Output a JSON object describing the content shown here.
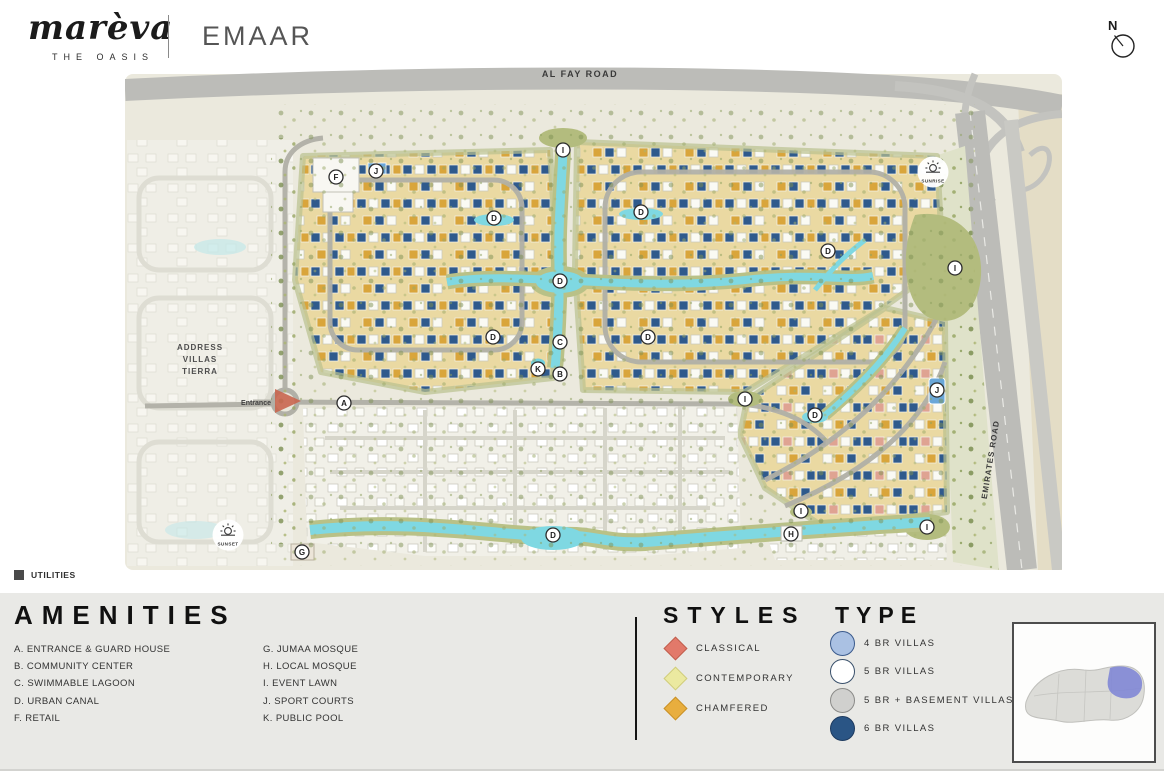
{
  "header": {
    "brand": "marèva",
    "brand_sub": "THE OASIS",
    "partner": "EMAAR",
    "compass_label": "N"
  },
  "map": {
    "road_top_label": "AL FAY ROAD",
    "road_right_label": "EMIRATES ROAD",
    "neighbor_label": [
      "ADDRESS",
      "VILLAS",
      "TIERRA"
    ],
    "entrance_label": "Entrance",
    "sun_badges": [
      {
        "label": "SUNRISE",
        "x": 808,
        "y": 112
      },
      {
        "label": "SUNSET",
        "x": 103,
        "y": 475
      }
    ],
    "markers": [
      {
        "letter": "A",
        "x": 219,
        "y": 343
      },
      {
        "letter": "B",
        "x": 435,
        "y": 314
      },
      {
        "letter": "C",
        "x": 435,
        "y": 282
      },
      {
        "letter": "K",
        "x": 413,
        "y": 309
      },
      {
        "letter": "F",
        "x": 211,
        "y": 117
      },
      {
        "letter": "J",
        "x": 251,
        "y": 111
      },
      {
        "letter": "J",
        "x": 812,
        "y": 330
      },
      {
        "letter": "G",
        "x": 177,
        "y": 492
      },
      {
        "letter": "H",
        "x": 666,
        "y": 474
      },
      {
        "letter": "I",
        "x": 438,
        "y": 90
      },
      {
        "letter": "I",
        "x": 830,
        "y": 208
      },
      {
        "letter": "I",
        "x": 620,
        "y": 339
      },
      {
        "letter": "I",
        "x": 676,
        "y": 451
      },
      {
        "letter": "I",
        "x": 802,
        "y": 467
      },
      {
        "letter": "D",
        "x": 369,
        "y": 158
      },
      {
        "letter": "D",
        "x": 516,
        "y": 152
      },
      {
        "letter": "D",
        "x": 435,
        "y": 221
      },
      {
        "letter": "D",
        "x": 368,
        "y": 277
      },
      {
        "letter": "D",
        "x": 523,
        "y": 277
      },
      {
        "letter": "D",
        "x": 703,
        "y": 191
      },
      {
        "letter": "D",
        "x": 690,
        "y": 355
      },
      {
        "letter": "D",
        "x": 428,
        "y": 475
      }
    ],
    "palette": {
      "sand": "#ebe9dd",
      "road": "#bcbcb8",
      "canal": "#7fd8e2",
      "park": "#b3bc7e",
      "district_yellow": "#ead9a2",
      "future_white": "#f1f0e8"
    }
  },
  "utilities": {
    "label": "UTILITIES",
    "swatch_color": "#4a4a4a"
  },
  "legend": {
    "amenities": {
      "title": "AMENITIES",
      "col1": [
        "A. ENTRANCE & GUARD HOUSE",
        "B. COMMUNITY CENTER",
        "C. SWIMMABLE LAGOON",
        "D. URBAN CANAL",
        "F. RETAIL"
      ],
      "col2": [
        "G. JUMAA MOSQUE",
        "H. LOCAL MOSQUE",
        "I. EVENT LAWN",
        "J. SPORT COURTS",
        "K. PUBLIC POOL"
      ]
    },
    "styles": {
      "title": "STYLES",
      "items": [
        {
          "label": "CLASSICAL",
          "color": "#e2796a",
          "border": "#c05f4e"
        },
        {
          "label": "CONTEMPORARY",
          "color": "#ebe9a0",
          "border": "#cfcc7d"
        },
        {
          "label": "CHAMFERED",
          "color": "#e8ae3e",
          "border": "#c89128"
        }
      ]
    },
    "types": {
      "title": "TYPE",
      "items": [
        {
          "label": "4 BR VILLAS",
          "color": "#aac1e3",
          "border": "#3a5a8c"
        },
        {
          "label": "5 BR VILLAS",
          "color": "#ffffff",
          "border": "#39506b"
        },
        {
          "label": "5 BR + BASEMENT VILLAS",
          "color": "#d0d0ce",
          "border": "#8a8a88"
        },
        {
          "label": "6 BR VILLAS",
          "color": "#2a5585",
          "border": "#1d3a5f"
        }
      ]
    }
  },
  "minimap": {
    "highlight_color": "#7b82d6"
  }
}
